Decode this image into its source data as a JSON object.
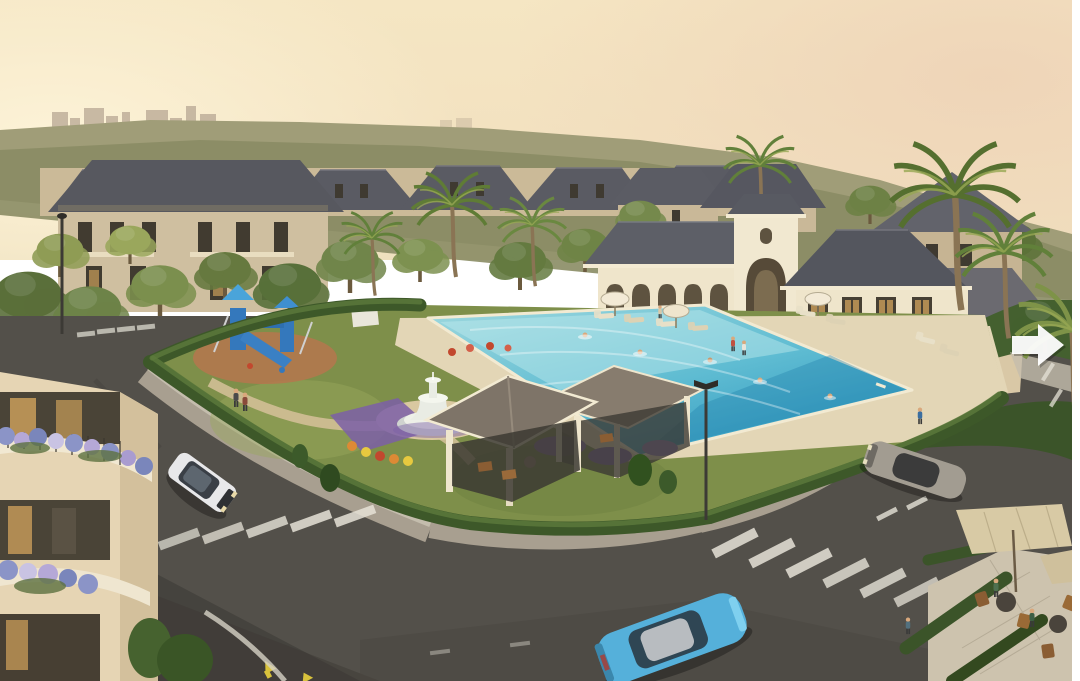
{
  "page": {
    "type": "image-carousel-slide",
    "alt": "Aerial sunset rendering of a resort-style residential community: Mediterranean clubhouse with arched colonnade, large turquoise swimming pool with loungers and umbrellas, twin gazebos, tiered fountain, children playground, hedge-ringed central park, tree-lined streets with crosswalks, white SUV, blue coupe and grey sports car, corner apartment with hydrangea balconies, and a sidewalk cafe with cream umbrellas"
  },
  "carousel": {
    "next_icon": "→"
  },
  "scene": {
    "elements": [
      "sky-sunset",
      "distant-city",
      "treeline",
      "townhouses",
      "villas",
      "clubhouse",
      "swimming-pool",
      "pool-deck",
      "umbrellas",
      "loungers",
      "fountain",
      "gazebos",
      "playground",
      "flower-beds",
      "hedge-border",
      "lawn",
      "roads",
      "sidewalks",
      "crosswalks",
      "lane-markings",
      "white-suv",
      "blue-coupe",
      "grey-sports-car",
      "corner-building-balconies",
      "hydrangeas",
      "street-cafe",
      "palm-trees",
      "street-lamps",
      "people"
    ]
  },
  "palette": {
    "frame_white": "#ffffff",
    "sky_top": "#f5e6c3",
    "sky_glow": "#fdf4d9",
    "sky_right": "#eed3b7",
    "treeline": "#a09d78",
    "treeline_dark": "#8a8c64",
    "roof_dark": "#5a5b63",
    "roof_light": "#70717a",
    "wall_cream": "#efe5cb",
    "wall_beige": "#cbba98",
    "window_dark": "#463f33",
    "window_glow": "#c99e5a",
    "pool_far": "#9ed8de",
    "pool_near": "#2c96bf",
    "deck": "#e3d6b6",
    "lawn": "#7e8f4a",
    "hedge": "#3d5829",
    "hedge_light": "#5d7a3c",
    "road": "#53504a",
    "road_shadow": "#3b3834",
    "sidewalk": "#c4bdad",
    "cobble": "#a89f90",
    "marking_white": "#e6e2d7",
    "marking_yellow": "#d8c23c",
    "playground_blue": "#3478bc",
    "playground_canopy": "#4aa4da",
    "playground_ground": "#b5774e",
    "fountain_white": "#eef0e8",
    "flower_purple": "#7b5fa7",
    "flower_red": "#c2482e",
    "flower_orange": "#dd8a35",
    "hydrangea_blue": "#8b94c7",
    "hydrangea_lilac": "#b5a8d7",
    "umbrella_cream": "#d8caa5",
    "car_white": "#e8e8ea",
    "car_blue": "#55b0da",
    "car_gray": "#a29c91",
    "wood_brown": "#8a5d33",
    "palm_green": "#61803a",
    "arrow_white": "#ffffff"
  }
}
